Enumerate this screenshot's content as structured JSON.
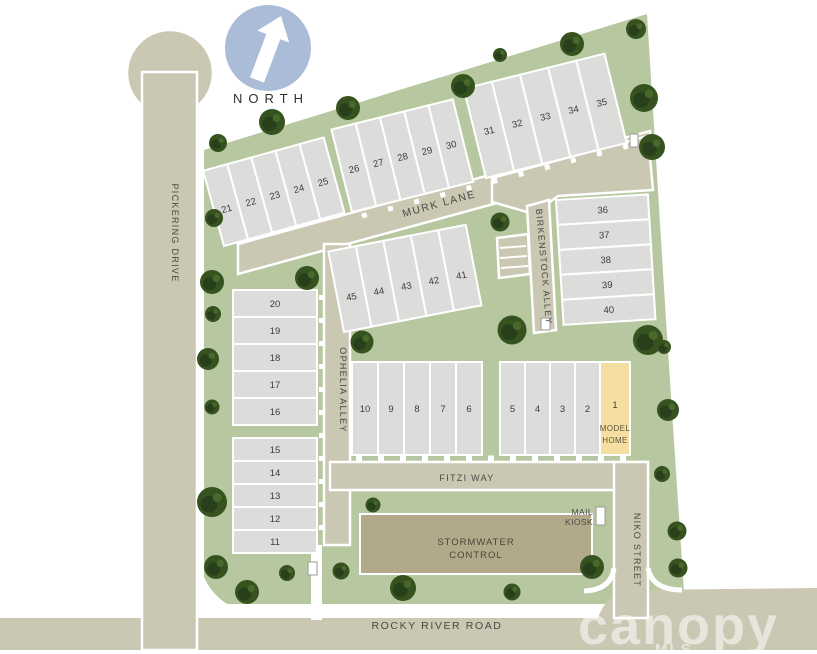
{
  "north_label": "NORTH",
  "streets": {
    "murk": "MURK LANE",
    "birkenstock": "BIRKENSTOCK ALLEY",
    "ophelia": "OPHELIA ALLEY",
    "pickering": "PICKERING DRIVE",
    "fitzi": "FITZI WAY",
    "niko": "NIKO STREET",
    "rocky": "ROCKY RIVER ROAD"
  },
  "features": {
    "stormwater_line1": "STORMWATER",
    "stormwater_line2": "CONTROL",
    "mail_line1": "MAIL",
    "mail_line2": "KIOSK",
    "model_number": "1",
    "model_line1": "MODEL",
    "model_line2": "HOME"
  },
  "lots": {
    "murk_west": [
      "21",
      "22",
      "23",
      "24",
      "25"
    ],
    "murk_mid": [
      "26",
      "27",
      "28",
      "29",
      "30"
    ],
    "murk_east": [
      "31",
      "32",
      "33",
      "34",
      "35"
    ],
    "birkenstock_block": [
      "36",
      "37",
      "38",
      "39",
      "40"
    ],
    "center_block": [
      "45",
      "44",
      "43",
      "42",
      "41"
    ],
    "west_block_north": [
      "20",
      "19",
      "18",
      "17",
      "16"
    ],
    "west_block_south": [
      "15",
      "14",
      "13",
      "12",
      "11"
    ],
    "fitzi_west": [
      "10",
      "9",
      "8",
      "7",
      "6"
    ],
    "fitzi_east": [
      "5",
      "4",
      "3",
      "2"
    ]
  },
  "watermark": {
    "brand": "canopy",
    "sub": "MLS"
  },
  "colors": {
    "road": "#cac7b3",
    "site": "#b7c8a0",
    "lot": "#dcdcda",
    "model": "#f4dfa0",
    "stormwater": "#b2a98b",
    "tree": "#35521f",
    "tree_dark": "#273f1a",
    "tree_light": "#48682c",
    "north_circle": "#aabcd7",
    "label": "#4a4a44",
    "number": "#3c3c3c"
  }
}
